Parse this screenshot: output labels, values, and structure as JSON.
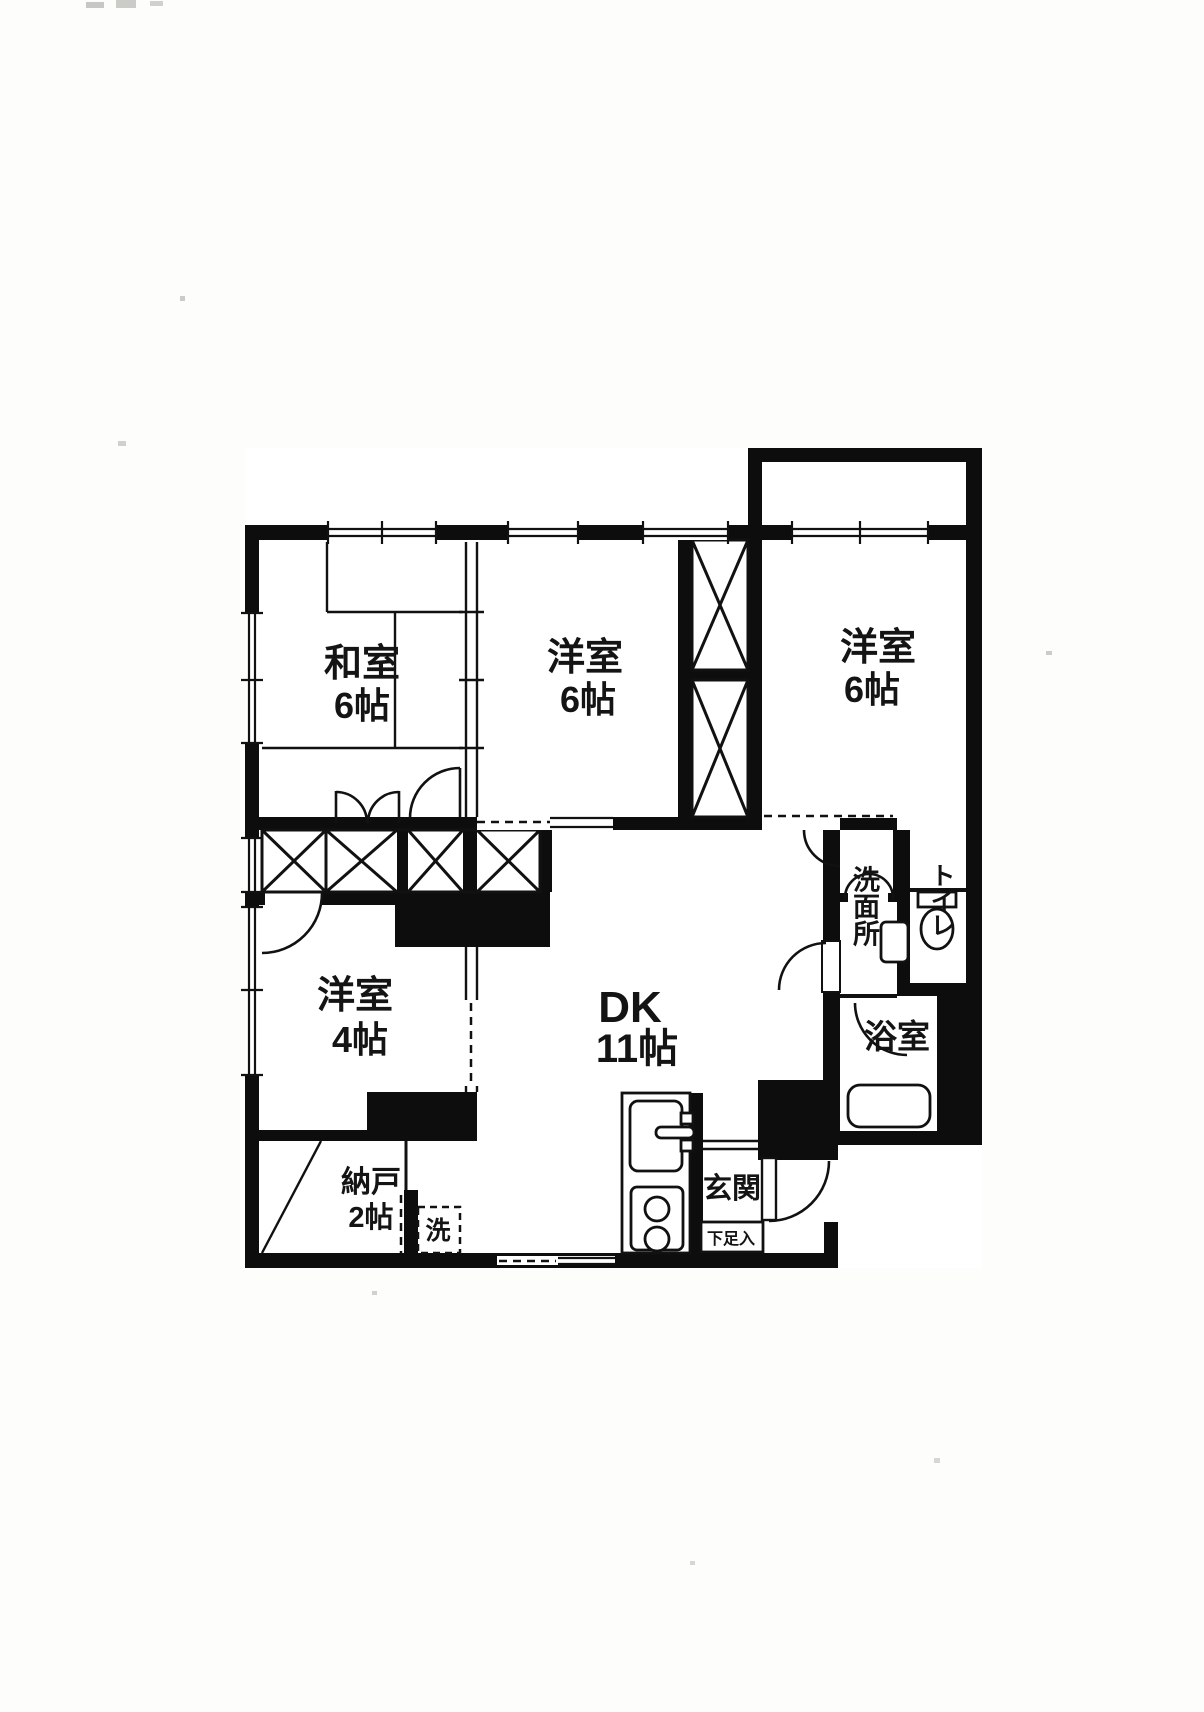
{
  "plan": {
    "kind": "apartment-floor-plan",
    "colors": {
      "wall": "#0d0d0d",
      "paper": "#fdfdfb"
    }
  },
  "rooms": {
    "japanese": {
      "name": "和室",
      "size": "6帖"
    },
    "western_center": {
      "name": "洋室",
      "size": "6帖"
    },
    "western_right": {
      "name": "洋室",
      "size": "6帖"
    },
    "western_small": {
      "name": "洋室",
      "size": "4帖"
    },
    "dining_kitchen": {
      "name": "DK",
      "size": "11帖"
    },
    "storage": {
      "name": "納戸",
      "size": "2帖"
    }
  },
  "utilities": {
    "washroom": "洗面所",
    "toilet": "トイレ",
    "bath": "浴室",
    "laundry": "洗",
    "entrance": "玄関",
    "shoe_cabinet": "下足入"
  }
}
